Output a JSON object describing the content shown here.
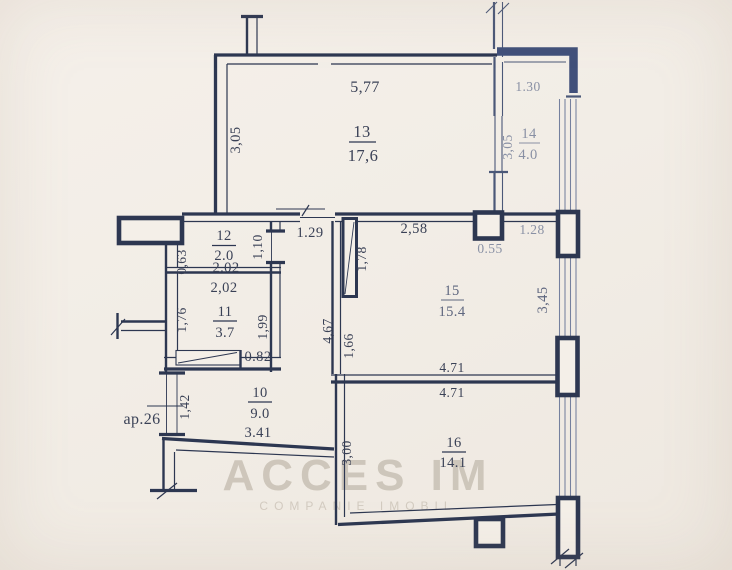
{
  "watermark": {
    "line1": "ACCES IM",
    "line2": "COMPANIE IMOBIL"
  },
  "apartment": {
    "label": "ap.26"
  },
  "rooms": {
    "r13": {
      "number": "13",
      "area": "17,6"
    },
    "r14": {
      "number": "14",
      "area": "4.0"
    },
    "r12": {
      "number": "12",
      "area": "2.0"
    },
    "r11": {
      "number": "11",
      "area": "3.7"
    },
    "r15": {
      "number": "15",
      "area": "15.4"
    },
    "r10": {
      "number": "10",
      "area": "9.0"
    },
    "r16": {
      "number": "16",
      "area": "14.1"
    }
  },
  "dimensions": {
    "top_width": "5,77",
    "room13_height": "3,05",
    "balcony_top": "1.30",
    "room14_height": "3,05",
    "door_room13": "1.29",
    "room15_top_left": "2,58",
    "room15_top_right": "1.28",
    "column_width": "0.55",
    "shaft_offset": "0,63",
    "room12_door": "1,10",
    "room12_width": "2.02",
    "room11_width": "2,02",
    "room11_height_left": "1,76",
    "room11_height_right": "1,99",
    "room15_door": "1,78",
    "hall_height": "4,67",
    "room15_wall": "1,66",
    "window_height": "3,45",
    "room11_door": "0.82",
    "room15_width": "4.71",
    "room16_width": "4.71",
    "entry_door": "1,42",
    "hall_width": "3.41",
    "room16_height": "3,00"
  }
}
